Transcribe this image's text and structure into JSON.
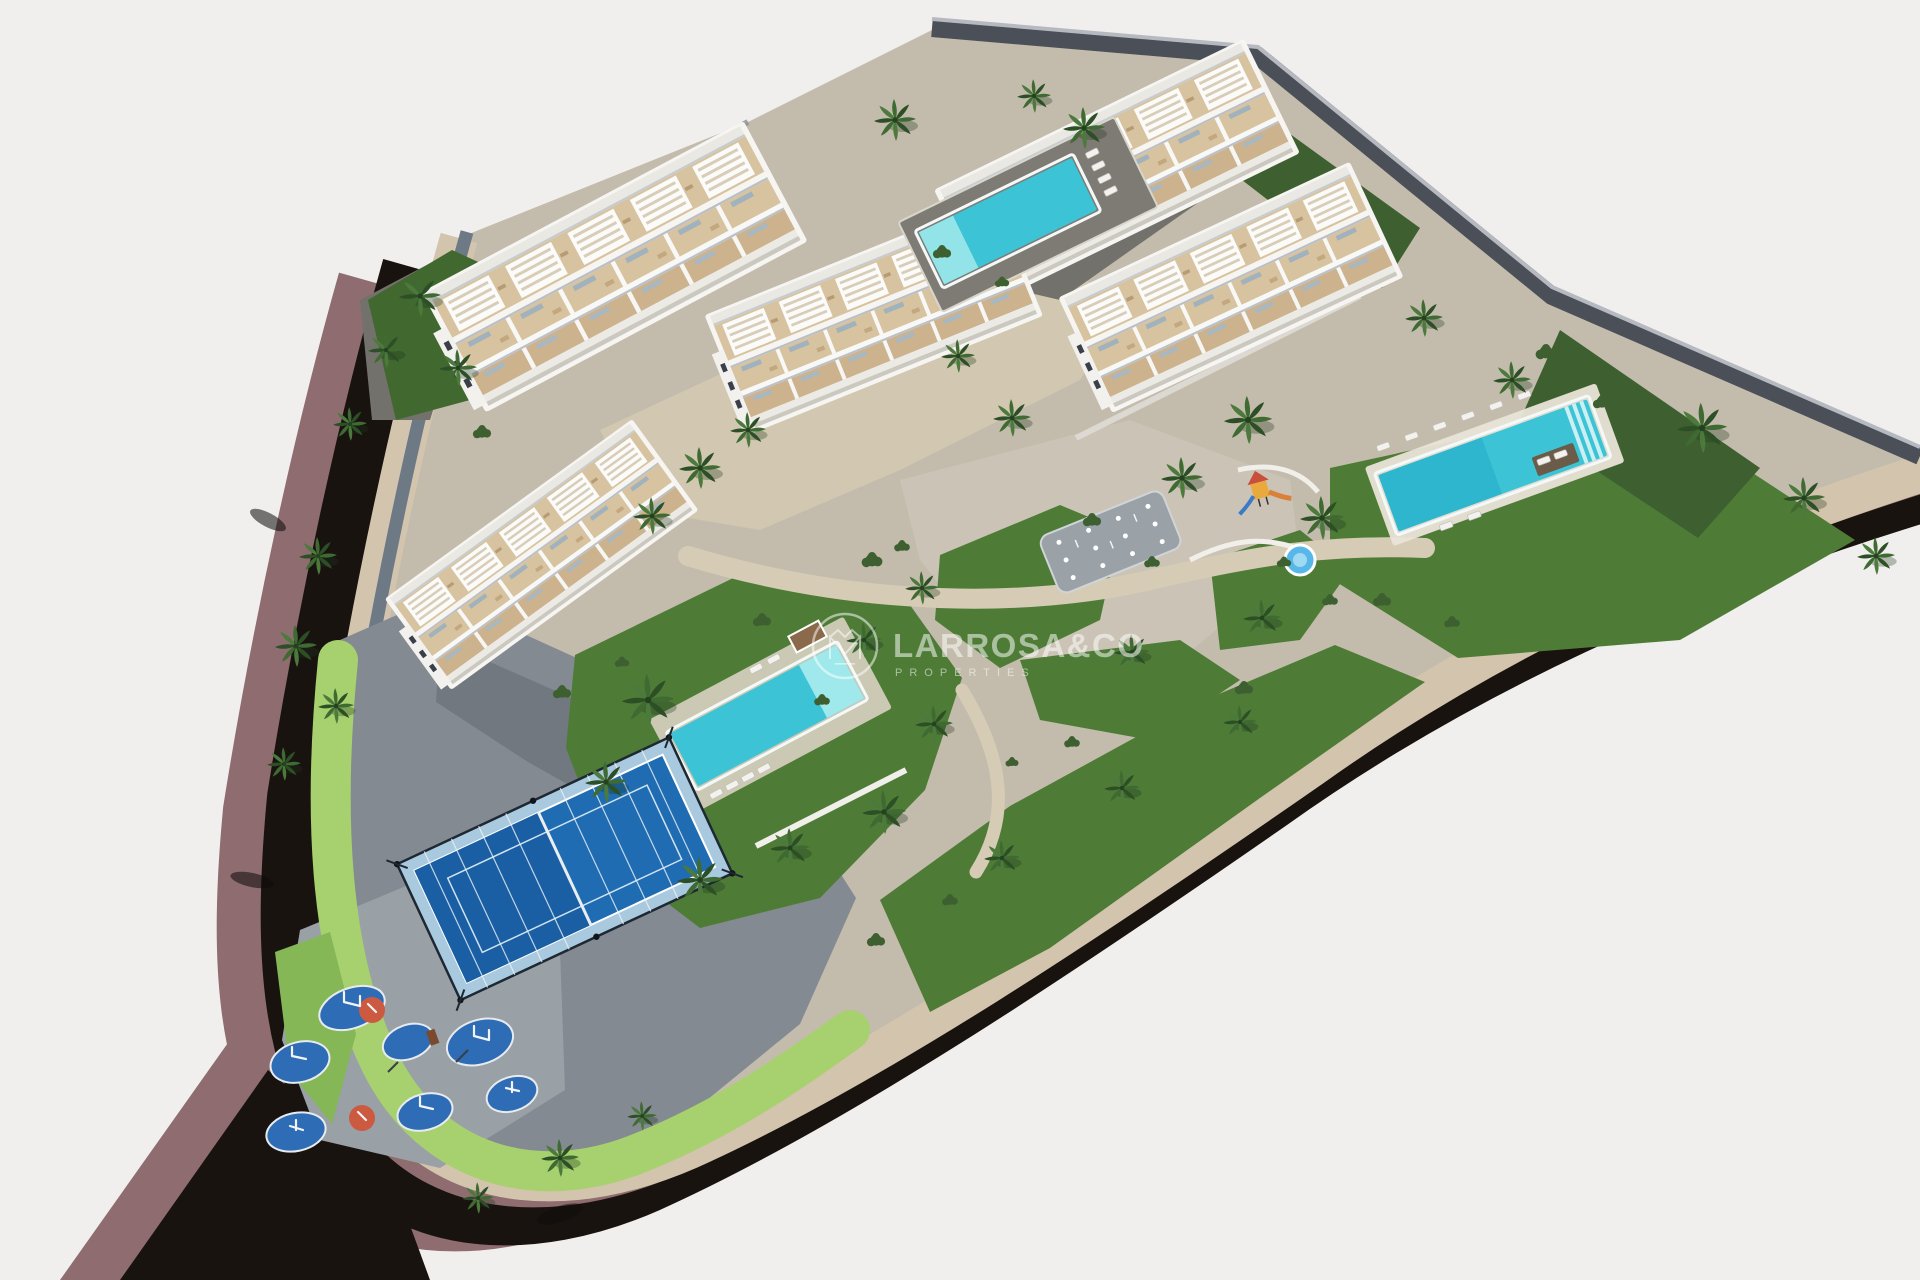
{
  "watermark": {
    "brand": "LARROSA&CO",
    "subtitle": "PROPERTIES",
    "logo_icon": "crown-monogram-ring-icon",
    "color": "#ffffff",
    "opacity": 0.52
  },
  "palette": {
    "background": "#f1efee",
    "road_asphalt": "#191310",
    "road_shoulder": "#8e6c6f",
    "curb_stone": "#d3c4ad",
    "wall_gray": "#6d7984",
    "perimeter_wall": "#4a4f58",
    "wall_light": "#b6bac0",
    "paving_base": "#c3bcac",
    "paving_plaza": "#d2c8b2",
    "paving_mid": "#848a91",
    "paving_dark": "#6a7078",
    "paving_pebble": "#99a0a6",
    "gravel_dark": "#72716c",
    "lawn": "#4e7c37",
    "lawn_bright": "#85b757",
    "grass_strip": "#a7d06e",
    "hedge": "#3e6030",
    "palm": "#3f6b33",
    "palm_dark": "#2c4f26",
    "pool_water": "#3cc3d5",
    "pool_shallow": "#93e4e9",
    "pool_deck": "#e9e4d8",
    "building_white": "#f6f5f2",
    "terrace": "#d7c39f",
    "terrace_dark": "#ccb28d",
    "padel_blue": "#1f6cb2",
    "padel_blue_dark": "#1a5fa3",
    "padel_glass": "#a9c9de",
    "frame_dark": "#1e2833",
    "rubber_blue": "#2e6db6",
    "rubber_orange": "#cc5a40",
    "equipment_white": "#f2f4f6",
    "splash_gray": "#9aa1a7",
    "kiddie_blue": "#57b7e8",
    "wm_white": "#ffffff"
  },
  "scene": {
    "view": "aerial-3d-architectural-render",
    "buildings": [
      {
        "id": "block-1",
        "position": "top-left"
      },
      {
        "id": "block-2",
        "position": "top-right"
      },
      {
        "id": "block-3",
        "position": "center"
      },
      {
        "id": "block-4",
        "position": "right"
      },
      {
        "id": "block-5",
        "position": "left"
      }
    ],
    "pools": [
      "top-plaza-pool",
      "east-garden-pool",
      "central-garden-pool",
      "kiddie-pool"
    ],
    "amenities": [
      "padel-court",
      "calisthenics-playground",
      "splash-pad",
      "kids-play-structure"
    ],
    "vegetation": [
      "palm-trees",
      "hedges",
      "lawns"
    ],
    "road": "dark-curved-perimeter-road"
  }
}
